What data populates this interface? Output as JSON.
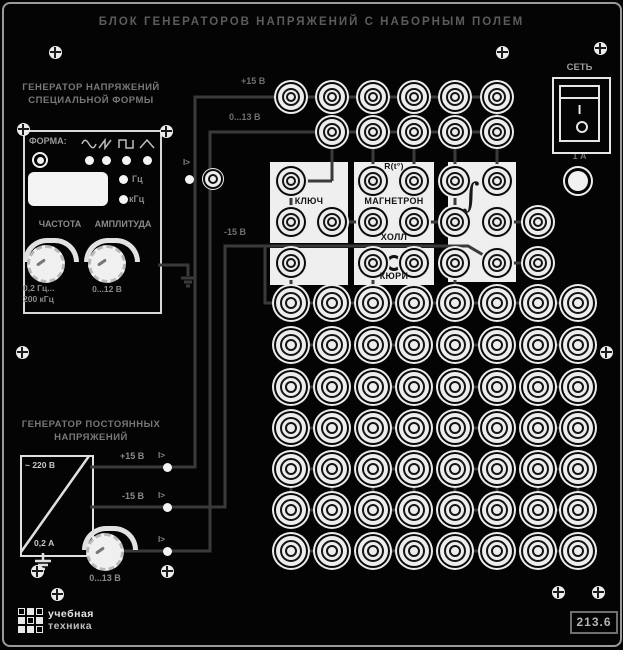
{
  "panel": {
    "title": "БЛОК ГЕНЕРАТОРОВ НАПРЯЖЕНИЙ С НАБОРНЫМ ПОЛЕМ",
    "model": "213.6",
    "brand_line1": "учебная",
    "brand_line2": "техника"
  },
  "power": {
    "label": "СЕТЬ",
    "fuse_label": "1 А",
    "on_symbol": "I",
    "off_symbol": "O"
  },
  "form_generator": {
    "title_line1": "ГЕНЕРАТОР НАПРЯЖЕНИЙ",
    "title_line2": "СПЕЦИАЛЬНОЙ ФОРМЫ",
    "form_label": "ФОРМА:",
    "waveforms": [
      "sine",
      "sawtooth",
      "square",
      "triangle"
    ],
    "hz_label": "Гц",
    "khz_label": "кГц",
    "freq_label": "ЧАСТОТА",
    "ampl_label": "АМПЛИТУДА",
    "freq_range_line1": "0,2 Гц...",
    "freq_range_line2": "200 кГц",
    "ampl_range": "0...12 В",
    "overload_label": "I>"
  },
  "dc_generator": {
    "title_line1": "ГЕНЕРАТОР ПОСТОЯННЫХ",
    "title_line2": "НАПРЯЖЕНИЙ",
    "mains_label": "~ 220 В",
    "current_label": "0,2 А",
    "out_plus15": "+15 В",
    "out_minus15": "-15 В",
    "out_adjustable": "0...13 В",
    "overload_label": "I>"
  },
  "patch_field": {
    "bus_plus15_label": "+15 В",
    "bus_adjustable_label": "0...13 В",
    "bus_minus15_label": "-15 В",
    "blocks": {
      "key": "КЛЮЧ",
      "thermistor": "R(t°)",
      "magnetron": "МАГНЕТРОН",
      "hall": "ХОЛЛ",
      "curie": "КЮРИ",
      "integrator": "∫"
    }
  },
  "colors": {
    "panel_bg": "#040404",
    "wire": "#3a3a3a",
    "white_element": "#ededed",
    "label_text": "#8a8a8a"
  }
}
